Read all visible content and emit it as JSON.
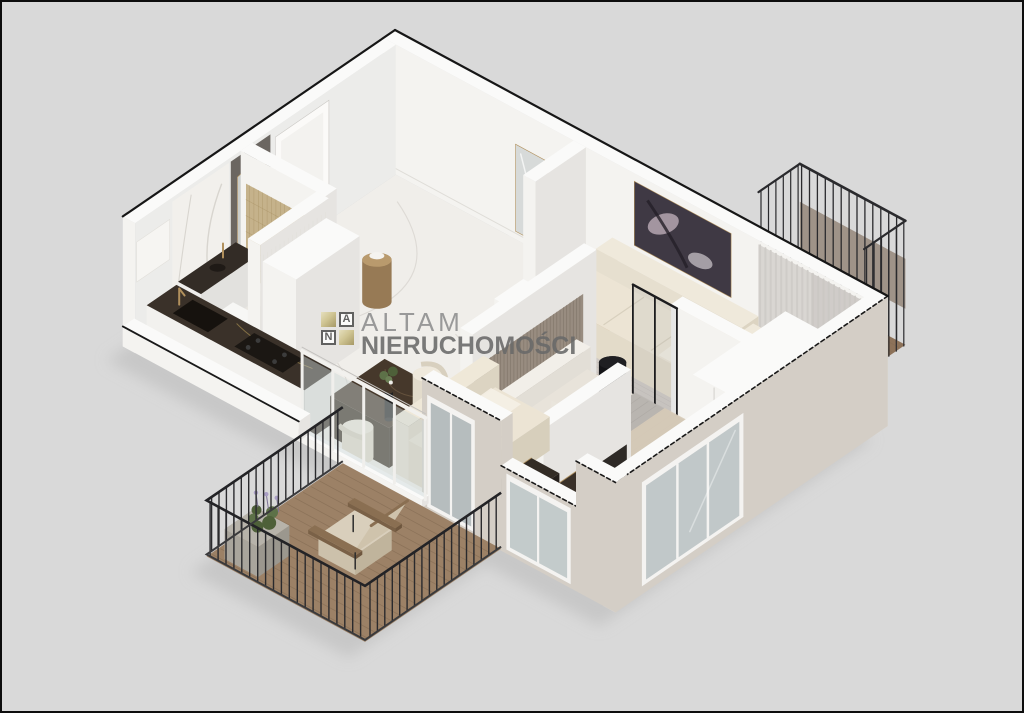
{
  "watermark": {
    "tile_letter_a": "A",
    "tile_letter_n": "N",
    "brand": "ALTAM",
    "brand_sub": "NIERUCHOMOŚCI",
    "gold": "#c3b67e",
    "tile_border": "#4f4f4f",
    "brand_color": "#8e8e8e",
    "brand_sub_color": "#696969"
  },
  "palette": {
    "background": "#d9d9d9",
    "frame": "#0d0d0d",
    "shadow": "#bdbdbd",
    "wall_top": "#fafaf9",
    "wall_south": "#f4f3f0",
    "wall_east": "#e6e4e1",
    "wall_inner": "#ececea",
    "wall_ext": "#d4cec6",
    "cutline": "#191919",
    "floor_marble": "#f0eeea",
    "floor_vein": "#d8d5cf",
    "floor_wood": "#c49b76",
    "floor_wood_line": "#a8815c",
    "floor_bedroom": "#dbd9d4",
    "floor_bath": "#e9e6e1",
    "floor_kitchen": "#3d342b",
    "deck": "#9c8166",
    "deck_line": "#826a52",
    "deck_small": "#8d7259",
    "gold": "#b1905c",
    "accent_panel": "#6b6661",
    "door_white": "#fbfaf8",
    "glass": "#b7c0c2",
    "railing": "#2a2a2d",
    "curtain": "#d9d6d2",
    "art_dark": "#3f3944",
    "art_mauve": "#b5a6b0",
    "sofa_cream": "#ece4d4",
    "sofa_beige": "#e6dfcf",
    "chair_beige": "#ddd3c0",
    "bed_white": "#e8e3da",
    "bed_gray": "#b9b5b0",
    "bed_beige": "#d7cbb8",
    "rug_gray": "#c6c4c1",
    "rug_beige": "#d8d1c2",
    "rug_room2": "#cfc9c4",
    "marble_dark": "#3a3129",
    "marble_dark2": "#46382b",
    "tile_tan": "#c5b28b",
    "wood_dark": "#8a6f52",
    "plant": "#5d7148",
    "flower": "#a99ec4",
    "black": "#1f1f22",
    "white_goods": "#f4f2ee"
  },
  "rooms": [
    {
      "name": "entrance-hall"
    },
    {
      "name": "bathroom"
    },
    {
      "name": "kitchen"
    },
    {
      "name": "second-room"
    },
    {
      "name": "bedroom"
    },
    {
      "name": "living-dining-room"
    },
    {
      "name": "main-balcony"
    },
    {
      "name": "small-balcony"
    }
  ]
}
